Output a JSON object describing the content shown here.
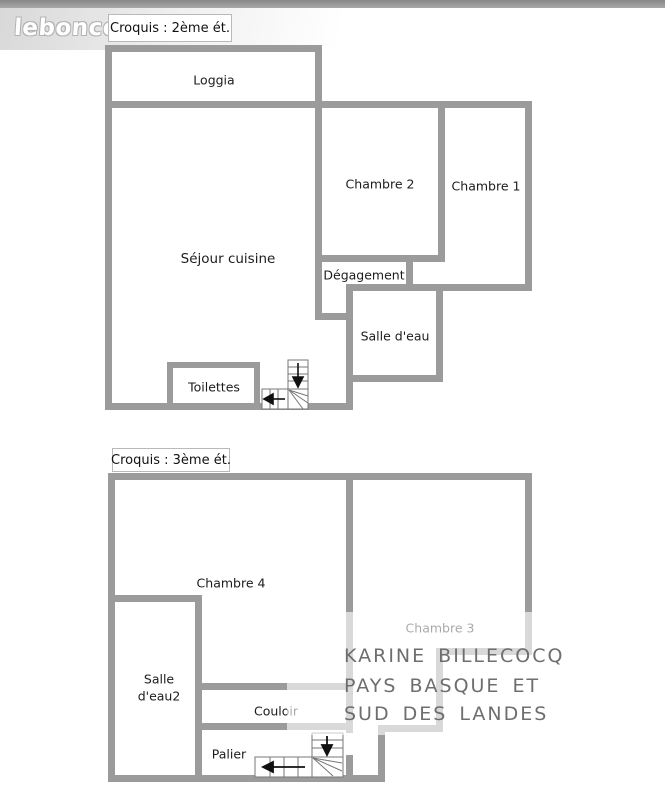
{
  "header": {
    "logo": "leboncoin"
  },
  "floor2": {
    "tag": "Croquis : 2ème ét.",
    "rooms": {
      "loggia": "Loggia",
      "sejour": "Séjour cuisine",
      "chambre2": "Chambre 2",
      "chambre1": "Chambre 1",
      "degagement": "Dégagement",
      "salle_eau": "Salle d'eau",
      "toilettes": "Toilettes"
    }
  },
  "floor3": {
    "tag": "Croquis : 3ème ét.",
    "rooms": {
      "chambre4": "Chambre 4",
      "chambre3": "Chambre 3",
      "salle_eau2_line1": "Salle",
      "salle_eau2_line2": "d'eau2",
      "couloir": "Couloir",
      "palier": "Palier"
    }
  },
  "watermark": {
    "line1": "KARINE BILLECOCQ",
    "line2": "PAYS BASQUE ET",
    "line3": "SUD DES LANDES"
  },
  "colors": {
    "wall": "#9b9b9b",
    "top_bar": "#8f8f8f",
    "label_text": "#1c1c1c",
    "watermark_text": "#6e6e6e",
    "background": "#ffffff"
  }
}
